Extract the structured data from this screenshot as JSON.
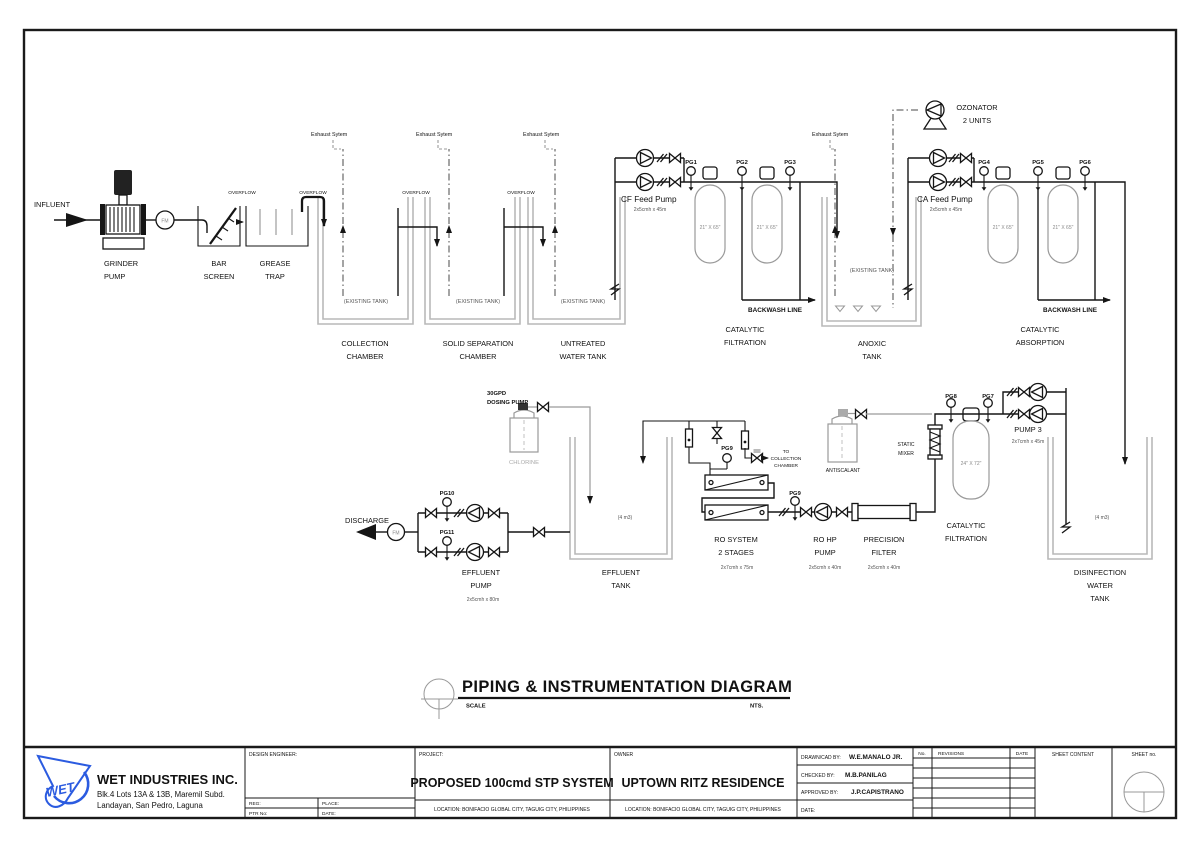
{
  "page": {
    "title": "PIPING & INSTRUMENTATION DIAGRAM",
    "scale_label": "SCALE",
    "scale_value": "NTS."
  },
  "labels": {
    "influent": "INFLUENT",
    "grinder_pump": [
      "GRINDER",
      "PUMP"
    ],
    "bar_screen": [
      "BAR",
      "SCREEN"
    ],
    "grease_trap": [
      "GREASE",
      "TRAP"
    ],
    "overflow": "OVERFLOW",
    "exhaust_system": "Exhaust Sytem",
    "existing_tank": "(EXISTING TANK)",
    "collection_chamber": [
      "COLLECTION",
      "CHAMBER"
    ],
    "solid_separation_chamber": [
      "SOLID SEPARATION",
      "CHAMBER"
    ],
    "untreated_water_tank": [
      "UNTREATED",
      "WATER TANK"
    ],
    "cf_feed_pump": "CF Feed Pump",
    "cf_feed_pump_spec": "2x5cmh x 45m",
    "ca_feed_pump": "CA Feed Pump",
    "ca_feed_pump_spec": "2x5cmh x 45m",
    "catalytic_filtration": [
      "CATALYTIC",
      "FILTRATION"
    ],
    "catalytic_absorption": [
      "CATALYTIC",
      "ABSORPTION"
    ],
    "anoxic_tank": [
      "ANOXIC",
      "TANK"
    ],
    "ozonator": [
      "OZONATOR",
      "2 UNITS"
    ],
    "backwash_line": "BACKWASH  LINE",
    "vessel_21x65": "21\" X 65\"",
    "vessel_24x72": "24\" X 72\"",
    "pg1": "PG1",
    "pg2": "PG2",
    "pg3": "PG3",
    "pg4": "PG4",
    "pg5": "PG5",
    "pg6": "PG6",
    "pg7": "PG7",
    "pg8": "PG8",
    "pg9": "PG9",
    "pg10": "PG10",
    "pg11": "PG11",
    "fm": "FM",
    "dosing_pump": [
      "30GPD",
      "DOSING  PUMP"
    ],
    "chlorine": "CHLORINE",
    "discharge": "DISCHARGE",
    "effluent_pump": [
      "EFFLUENT",
      "PUMP"
    ],
    "effluent_pump_spec": "2x5cmh x 80m",
    "effluent_tank": [
      "EFFLUENT",
      "TANK"
    ],
    "four_m3": "(4 m3)",
    "ro_system": [
      "RO SYSTEM",
      "2 STAGES"
    ],
    "ro_system_spec": "2x7cmh x 75m",
    "to_collection_chamber": [
      "TO",
      "COLLECTION",
      "CHAMBER"
    ],
    "ro_hp_pump": [
      "RO HP",
      "PUMP"
    ],
    "ro_hp_pump_spec": "2x5cmh x 40m",
    "precision_filter": [
      "PRECISION",
      "FILTER"
    ],
    "precision_filter_spec": "2x5cmh x 40m",
    "static_mixer": [
      "STATIC",
      "MIXER"
    ],
    "antiscalant": "ANTISCALANT",
    "pump3": "PUMP 3",
    "pump3_spec": "2x7cmh x 45m",
    "disinfection_tank": [
      "DISINFECTION",
      "WATER",
      "TANK"
    ]
  },
  "title_block": {
    "company_logo": "WET",
    "company": "WET INDUSTRIES INC.",
    "address": [
      "Blk.4 Lots 13A & 13B, Maremil Subd.",
      "Landayan, San Pedro, Laguna"
    ],
    "design_engineer_label": "DESIGN ENGINEER:",
    "reg_label": "REG:",
    "place_label": "PLACE:",
    "ptr_label": "PTR No:",
    "date_label": "DATE:",
    "project_label": "PROJECT:",
    "project_name": "PROPOSED 100cmd STP SYSTEM",
    "location": "LOCATION:  BONIFACIO GLOBAL CITY, TAGUIG CITY, PHILIPPINES",
    "owner_label": "OWNER",
    "owner_name": "UPTOWN RITZ RESIDENCE",
    "drawn_label": "DRAWN/CAD BY:",
    "drawn_by": "W.E.MANALO JR.",
    "checked_label": "CHECKED BY:",
    "checked_by": "M.B.PANILAG",
    "approved_label": "APPROVED BY:",
    "approved_by": "J.P.CAPISTRANO",
    "date2_label": "DATE:",
    "rev_no_label": "No.",
    "revisions_label": "REVISIONS",
    "rev_date_label": "DATE",
    "sheet_content_label": "SHEET CONTENT",
    "sheet_no_label": "SHEET no."
  },
  "colors": {
    "line": "#151515",
    "existing_tank": "#b9b9b9",
    "chemical": "#9a9a9a",
    "logo_blue": "#2b5be0"
  }
}
